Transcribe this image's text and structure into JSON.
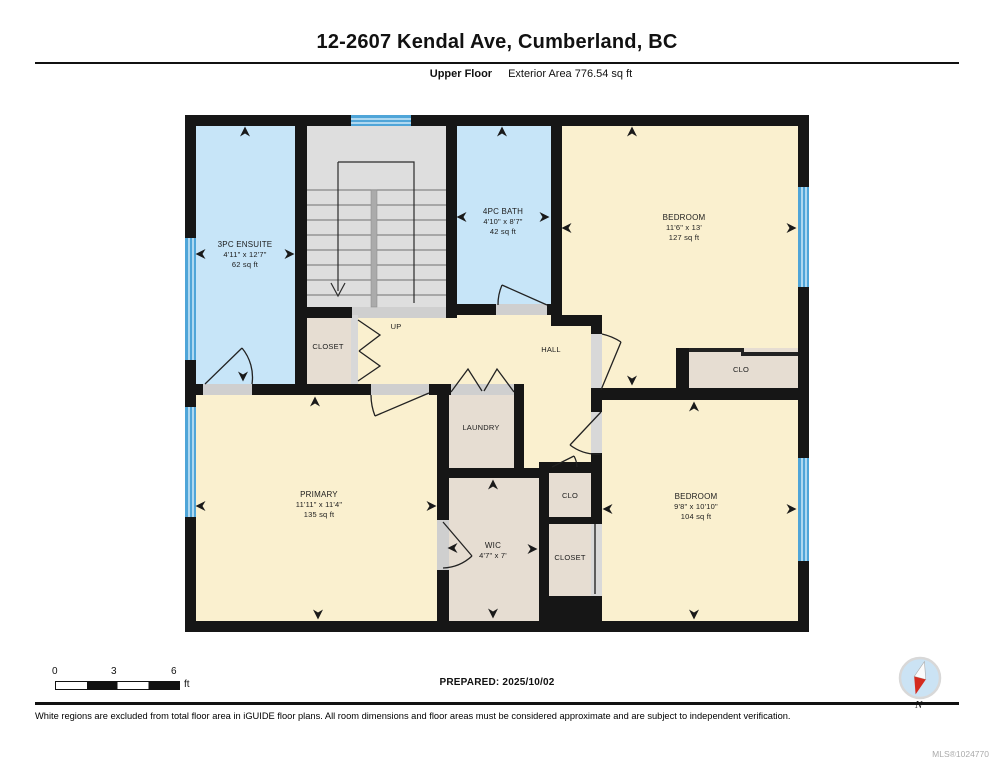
{
  "header": {
    "title": "12-2607 Kendal Ave, Cumberland, BC",
    "floor_label": "Upper Floor",
    "area_label": "Exterior Area 776.54 sq ft"
  },
  "plan": {
    "rooms": {
      "ensuite": {
        "name": "3PC ENSUITE",
        "dims": "4'11\" x 12'7\"",
        "area": "62 sq ft"
      },
      "bath": {
        "name": "4PC BATH",
        "dims": "4'10\" x 8'7\"",
        "area": "42 sq ft"
      },
      "bedroom_top": {
        "name": "BEDROOM",
        "dims": "11'6\" x 13'",
        "area": "127 sq ft"
      },
      "closet_top": {
        "name": "CLOSET"
      },
      "up": {
        "name": "UP"
      },
      "hall": {
        "name": "HALL"
      },
      "clo_top": {
        "name": "CLO"
      },
      "primary": {
        "name": "PRIMARY",
        "dims": "11'11\" x 11'4\"",
        "area": "135 sq ft"
      },
      "laundry": {
        "name": "LAUNDRY"
      },
      "wic": {
        "name": "WIC",
        "dims": "4'7\" x 7'"
      },
      "clo_mid": {
        "name": "CLO"
      },
      "closet_bottom": {
        "name": "CLOSET"
      },
      "bedroom_bottom": {
        "name": "BEDROOM",
        "dims": "9'8\" x 10'10\"",
        "area": "104 sq ft"
      }
    }
  },
  "scale": {
    "ticks": [
      "0",
      "3",
      "6"
    ],
    "unit": "ft"
  },
  "prepared_label": "PREPARED: 2025/10/02",
  "compass": {
    "label": "N"
  },
  "footer": {
    "disclaimer": "White regions are excluded from total floor area in iGUIDE floor plans. All room dimensions and floor areas must be considered approximate and are subject to independent verification.",
    "mls": "MLS®1024770"
  },
  "colors": {
    "wall": "#161616",
    "room_cream": "#FAF0CF",
    "room_blue": "#C7E5F8",
    "room_beige": "#E6DDD2",
    "stairs_gray": "#DEDEDE",
    "window_blue": "#4FA5D8",
    "compass_red": "#D42B1E"
  }
}
